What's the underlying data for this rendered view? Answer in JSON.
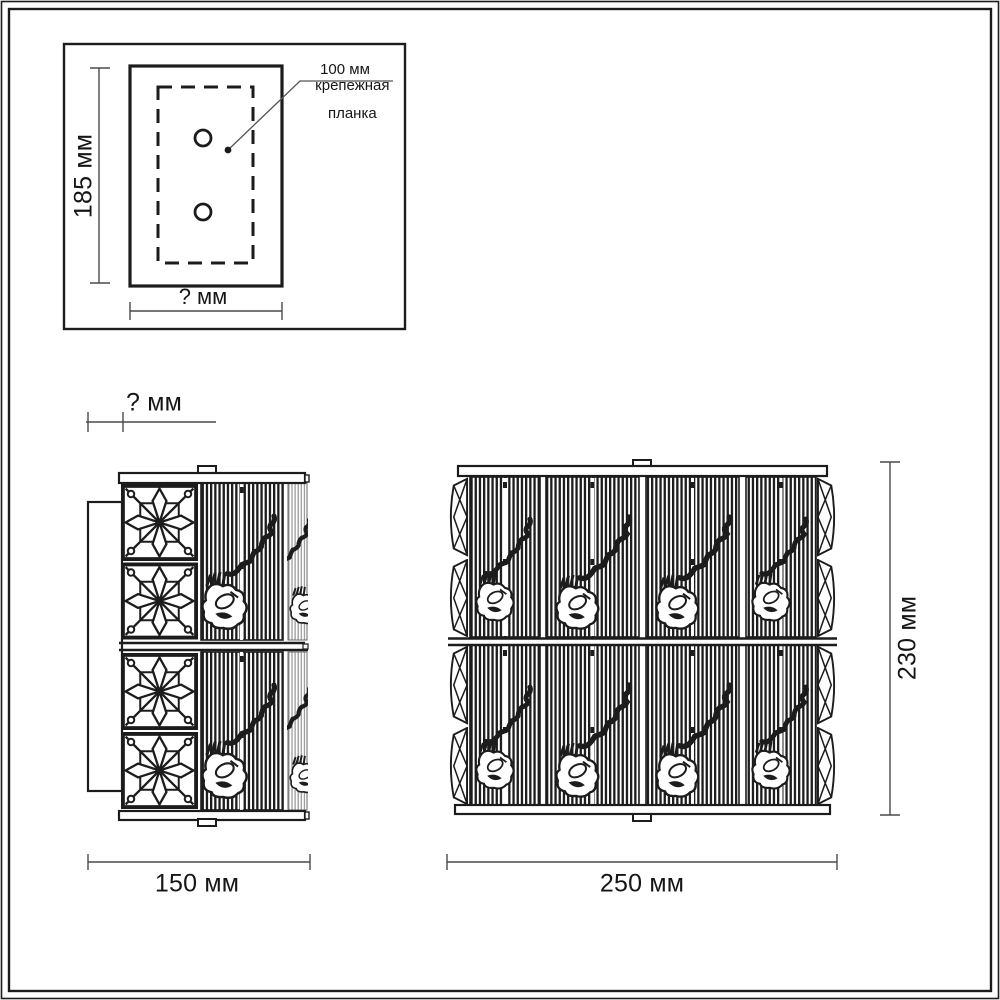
{
  "diagram": {
    "inset": {
      "height": "185 мм",
      "width": "? мм",
      "hole_spacing": "100 мм",
      "part_line1": "крепежная",
      "part_line2": "планка"
    },
    "side_view": {
      "depth": "? мм",
      "width": "150 мм"
    },
    "front_view": {
      "width": "250 мм",
      "height": "230 мм"
    },
    "colors": {
      "ink": "#1c1c1c",
      "dim_line": "#4a4a4a",
      "stripe_light": "#949494",
      "background": "#ffffff"
    }
  }
}
